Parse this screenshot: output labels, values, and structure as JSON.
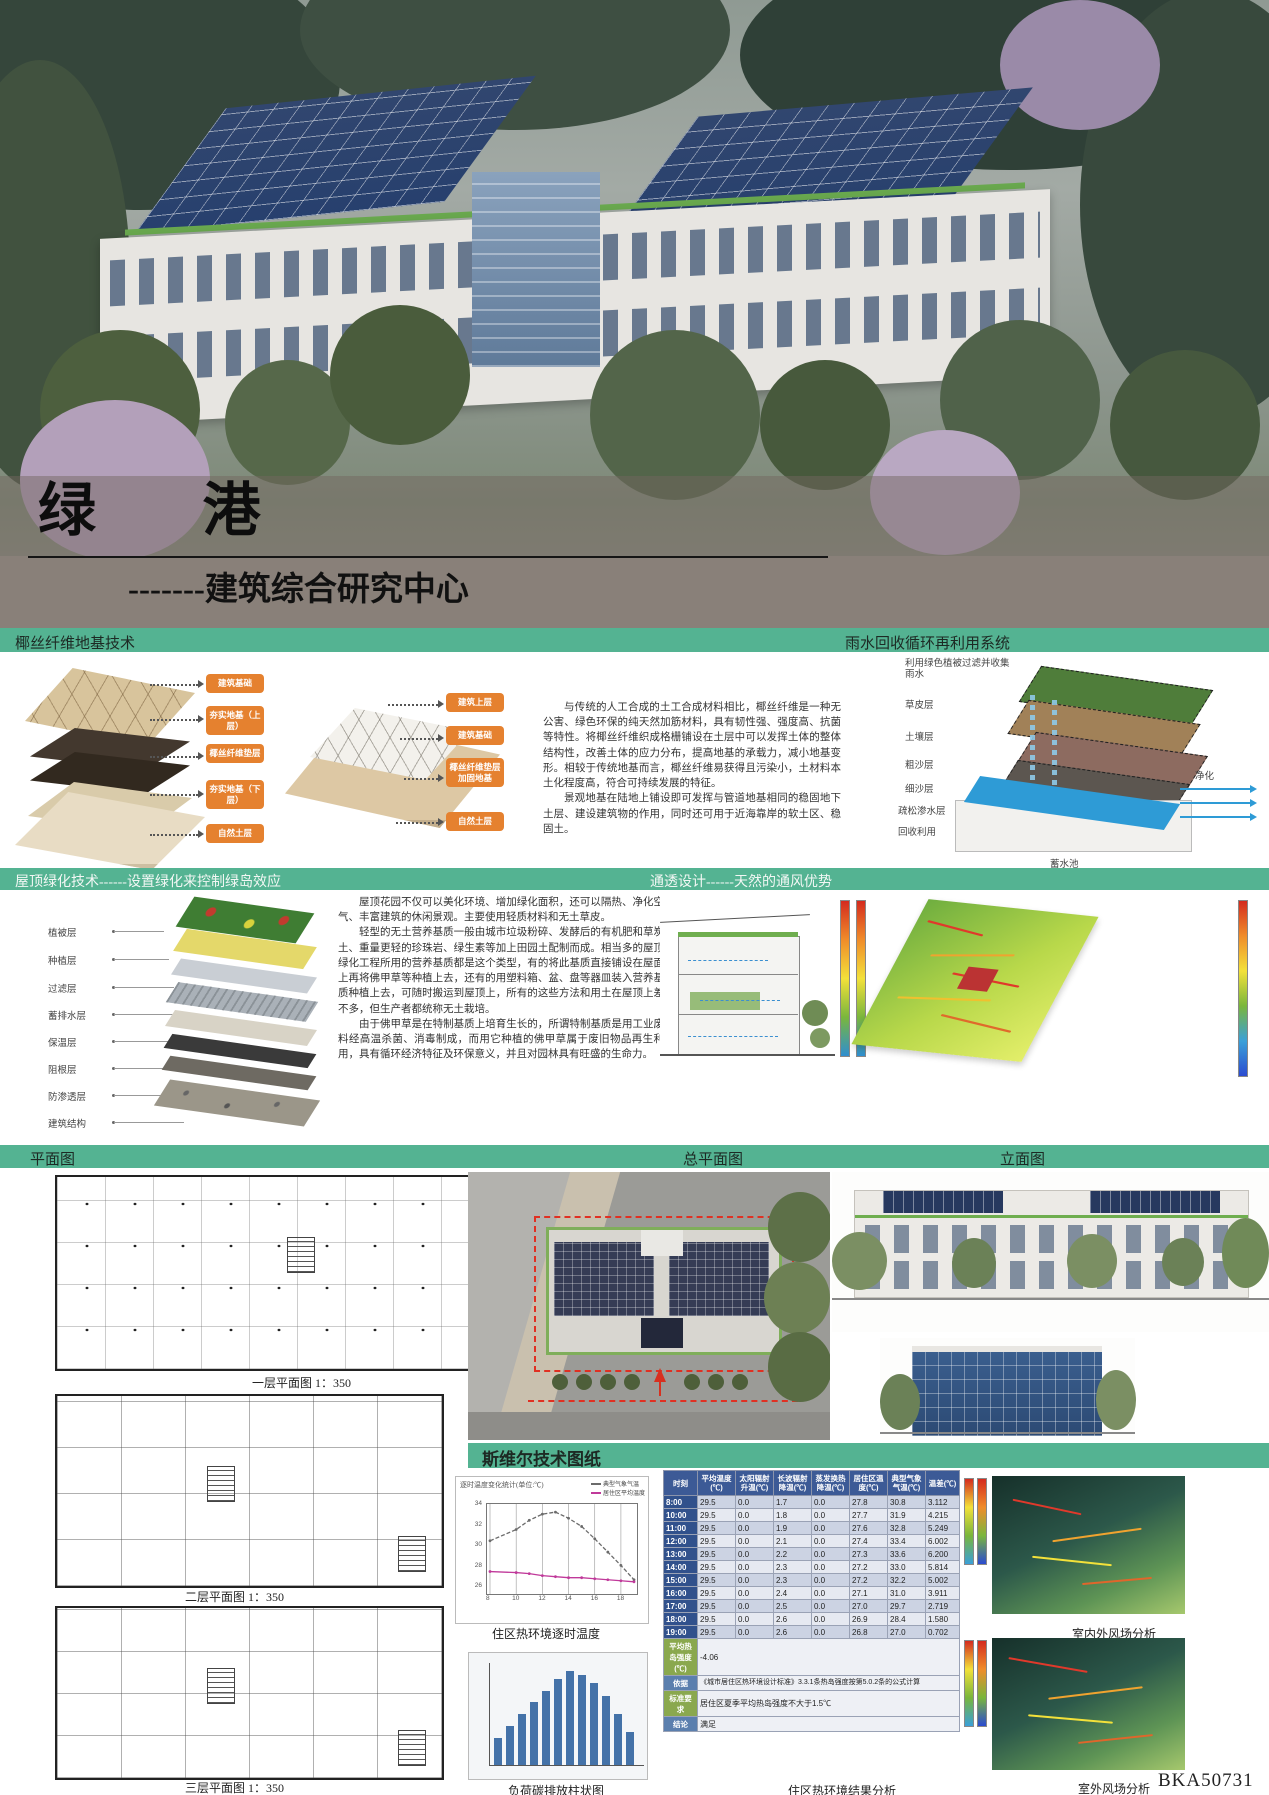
{
  "poster": {
    "title": "绿 港",
    "subtitle": "-------建筑综合研究中心",
    "board_id": "BKA50731"
  },
  "bands": {
    "foundation": "椰丝纤维地基技术",
    "rainwater": "雨水回收循环再利用系统",
    "roof": "屋顶绿化技术------设置绿化来控制绿岛效应",
    "ventilation": "通透设计------天然的通风优势",
    "plan": "平面图",
    "site_plan": "总平面图",
    "elevation": "立面图",
    "siwei": "斯维尔技术图纸"
  },
  "foundation": {
    "diagram_a_labels": [
      "建筑基础",
      "夯实地基（上层）",
      "椰丝纤维垫层",
      "夯实地基（下层）",
      "自然土层"
    ],
    "diagram_b_labels": [
      "建筑上层",
      "建筑基础",
      "椰丝纤维垫层加固地基",
      "自然土层"
    ],
    "paragraph1": "与传统的人工合成的土工合成材料相比，椰丝纤维是一种无公害、绿色环保的纯天然加筋材料，具有韧性强、强度高、抗菌等特性。将椰丝纤维织成格栅铺设在土层中可以发挥土体的整体结构性，改善土体的应力分布，提高地基的承载力，减小地基变形。相较于传统地基而言，椰丝纤维易获得且污染小，土材料本土化程度高，符合可持续发展的特征。",
    "paragraph2": "景观地基在陆地上铺设即可发挥与管道地基相同的稳固地下土层、建设建筑物的作用，同时还可用于近海靠岸的软土区、稳固土。"
  },
  "rainwater": {
    "note": "利用绿色植被过滤并收集雨水",
    "layer_labels": [
      "草皮层",
      "土壤层",
      "粗沙层",
      "细沙层",
      "疏松渗水层",
      "回收利用"
    ],
    "pool_label": "蓄水池",
    "purify_label": "净化"
  },
  "roof": {
    "layer_labels": [
      "植被层",
      "种植层",
      "过滤层",
      "蓄排水层",
      "保温层",
      "阻根层",
      "防渗透层",
      "建筑结构"
    ],
    "paragraph1": "屋顶花园不仅可以美化环境、增加绿化面积，还可以隔热、净化空气、丰富建筑的休闲景观。主要使用轻质材料和无土草皮。",
    "paragraph2": "轻型的无土营养基质一般由城市垃圾粉碎、发酵后的有机肥和草炭土、重量更轻的珍珠岩、绿生素等加上田园土配制而成。相当多的屋顶绿化工程所用的营养基质都是这个类型，有的将此基质直接铺设在屋面上再将佛甲草等种植上去，还有的用塑料箱、盆、盘等器皿装入营养基质种植上去，可随时搬运到屋顶上，所有的这些方法和用土在屋顶上差不多，但生产者都统称无土栽培。",
    "paragraph3": "由于佛甲草是在特制基质上培育生长的，所谓特制基质是用工业废料经高温杀菌、消毒制成，而用它种植的佛甲草属于废旧物品再生利用，具有循环经济特征及环保意义，并且对园林具有旺盛的生命力。"
  },
  "plans": {
    "captions": [
      "一层平面图 1：350",
      "二层平面图 1：350",
      "三层平面图 1：350"
    ]
  },
  "siwei": {
    "line_caption": "住区热环境逐时温度",
    "bar_caption": "负荷碳排放柱状图",
    "table_caption": "住区热环境结果分析",
    "wind_caption_top": "室内外风场分析",
    "wind_caption_bottom": "室外风场分析"
  },
  "chart_data": [
    {
      "type": "line",
      "title": "逐时温度变化统计(单位:℃)",
      "caption": "住区热环境逐时温度",
      "x": [
        8,
        10,
        11,
        12,
        13,
        14,
        15,
        16,
        17,
        18,
        19
      ],
      "x_ticks": [
        8,
        10,
        12,
        14,
        16,
        18
      ],
      "ylim": [
        26,
        34
      ],
      "legend_position": "top-right",
      "series": [
        {
          "name": "典型气象气温",
          "color": "#6b6b6b",
          "values": [
            30.8,
            31.9,
            32.8,
            33.4,
            33.6,
            33.0,
            32.2,
            31.0,
            29.7,
            28.4,
            27.0
          ]
        },
        {
          "name": "居住区平均温度",
          "color": "#c0399a",
          "values": [
            27.8,
            27.7,
            27.6,
            27.4,
            27.3,
            27.2,
            27.2,
            27.1,
            27.0,
            26.9,
            26.8
          ]
        }
      ]
    },
    {
      "type": "bar",
      "title": "负荷碳排放柱状图",
      "categories": [
        "1",
        "2",
        "3",
        "4",
        "5",
        "6",
        "7",
        "8",
        "9",
        "10",
        "11",
        "12"
      ],
      "values": [
        28,
        40,
        52,
        64,
        76,
        88,
        96,
        92,
        84,
        70,
        52,
        34
      ],
      "ylim": [
        0,
        100
      ],
      "color": "#4472a8"
    },
    {
      "type": "table",
      "title": "住区热环境结果分析",
      "columns": [
        "时刻",
        "平均温度(℃)",
        "太阳辐射升温(℃)",
        "长波辐射降温(℃)",
        "蒸发换热降温(℃)",
        "居住区温度(℃)",
        "典型气象气温(℃)",
        "温差(℃)"
      ],
      "rows": [
        [
          "8:00",
          "29.5",
          "0.0",
          "1.7",
          "0.0",
          "27.8",
          "30.8",
          "3.112"
        ],
        [
          "10:00",
          "29.5",
          "0.0",
          "1.8",
          "0.0",
          "27.7",
          "31.9",
          "4.215"
        ],
        [
          "11:00",
          "29.5",
          "0.0",
          "1.9",
          "0.0",
          "27.6",
          "32.8",
          "5.249"
        ],
        [
          "12:00",
          "29.5",
          "0.0",
          "2.1",
          "0.0",
          "27.4",
          "33.4",
          "6.002"
        ],
        [
          "13:00",
          "29.5",
          "0.0",
          "2.2",
          "0.0",
          "27.3",
          "33.6",
          "6.200"
        ],
        [
          "14:00",
          "29.5",
          "0.0",
          "2.3",
          "0.0",
          "27.2",
          "33.0",
          "5.814"
        ],
        [
          "15:00",
          "29.5",
          "0.0",
          "2.3",
          "0.0",
          "27.2",
          "32.2",
          "5.002"
        ],
        [
          "16:00",
          "29.5",
          "0.0",
          "2.4",
          "0.0",
          "27.1",
          "31.0",
          "3.911"
        ],
        [
          "17:00",
          "29.5",
          "0.0",
          "2.5",
          "0.0",
          "27.0",
          "29.7",
          "2.719"
        ],
        [
          "18:00",
          "29.5",
          "0.0",
          "2.6",
          "0.0",
          "26.9",
          "28.4",
          "1.580"
        ],
        [
          "19:00",
          "29.5",
          "0.0",
          "2.6",
          "0.0",
          "26.8",
          "27.0",
          "0.702"
        ]
      ],
      "summary": [
        {
          "label": "平均热岛强度(℃)",
          "value": "-4.06"
        },
        {
          "label": "依据",
          "value": "《城市居住区热环境设计标准》3.3.1条热岛强度按第5.0.2条的公式计算"
        },
        {
          "label": "标准要求",
          "value": "居住区夏季平均热岛强度不大于1.5℃"
        },
        {
          "label": "结论",
          "value": "满足"
        }
      ]
    }
  ],
  "colors": {
    "band_green": "#54b392",
    "label_orange": "#e5812f",
    "table_header_blue": "#3c5a96",
    "time_column_blue": "#31518c",
    "summary_green": "#8aa84e",
    "summary_blue": "#5b7fae",
    "solar_panel_blue": "#27406e",
    "pool_blue": "#2e9bd6"
  }
}
